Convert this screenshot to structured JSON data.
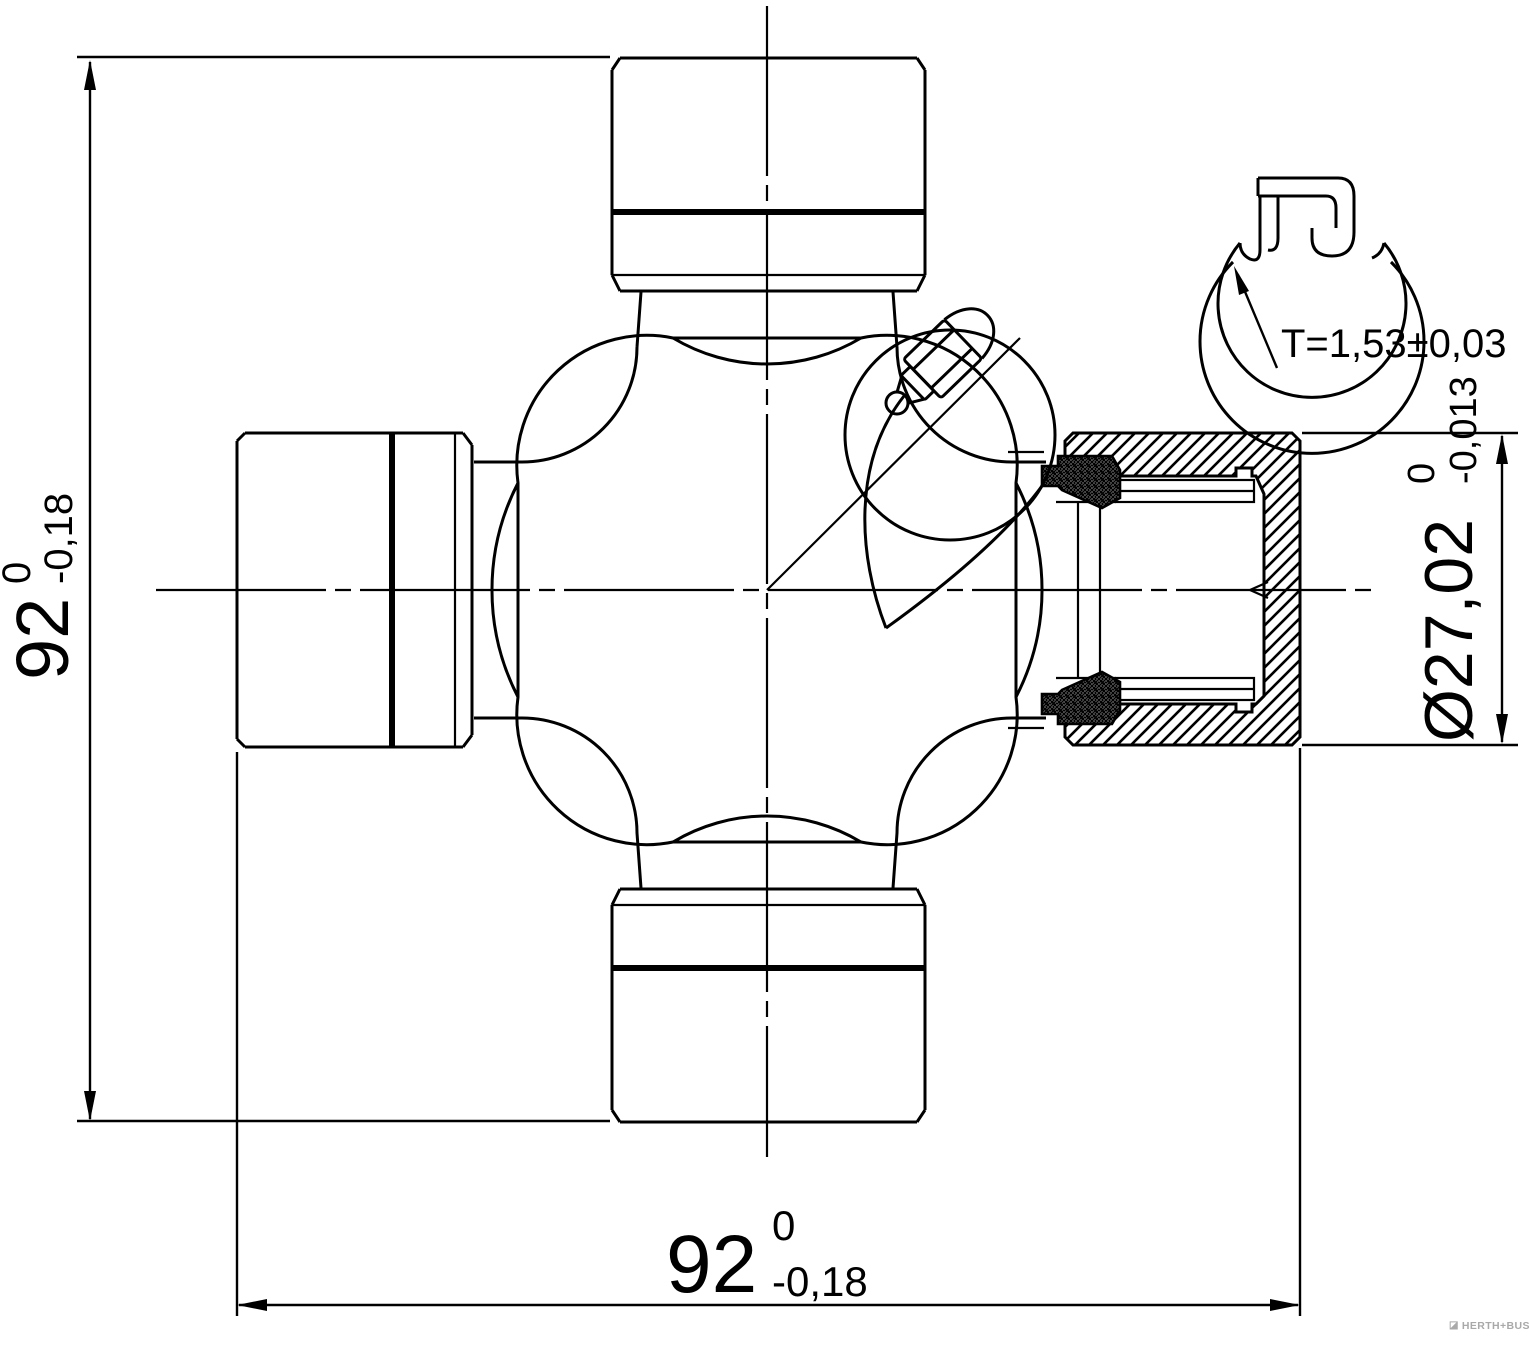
{
  "dimensions": {
    "height": {
      "value": "92",
      "tol_upper": "0",
      "tol_lower": "-0,18"
    },
    "width": {
      "value": "92",
      "tol_upper": "0",
      "tol_lower": "-0,18"
    },
    "cap_diameter": {
      "value": "Ø27,02",
      "tol_upper": "0",
      "tol_lower": "-0,013"
    }
  },
  "detail_view": {
    "label": "T=1,53±0,03"
  },
  "watermark": {
    "text": "HERTH+BUSS",
    "icon_glyph": "◪"
  },
  "colors": {
    "line": "#000000",
    "background": "#ffffff",
    "watermark": "#a9a9a9"
  }
}
